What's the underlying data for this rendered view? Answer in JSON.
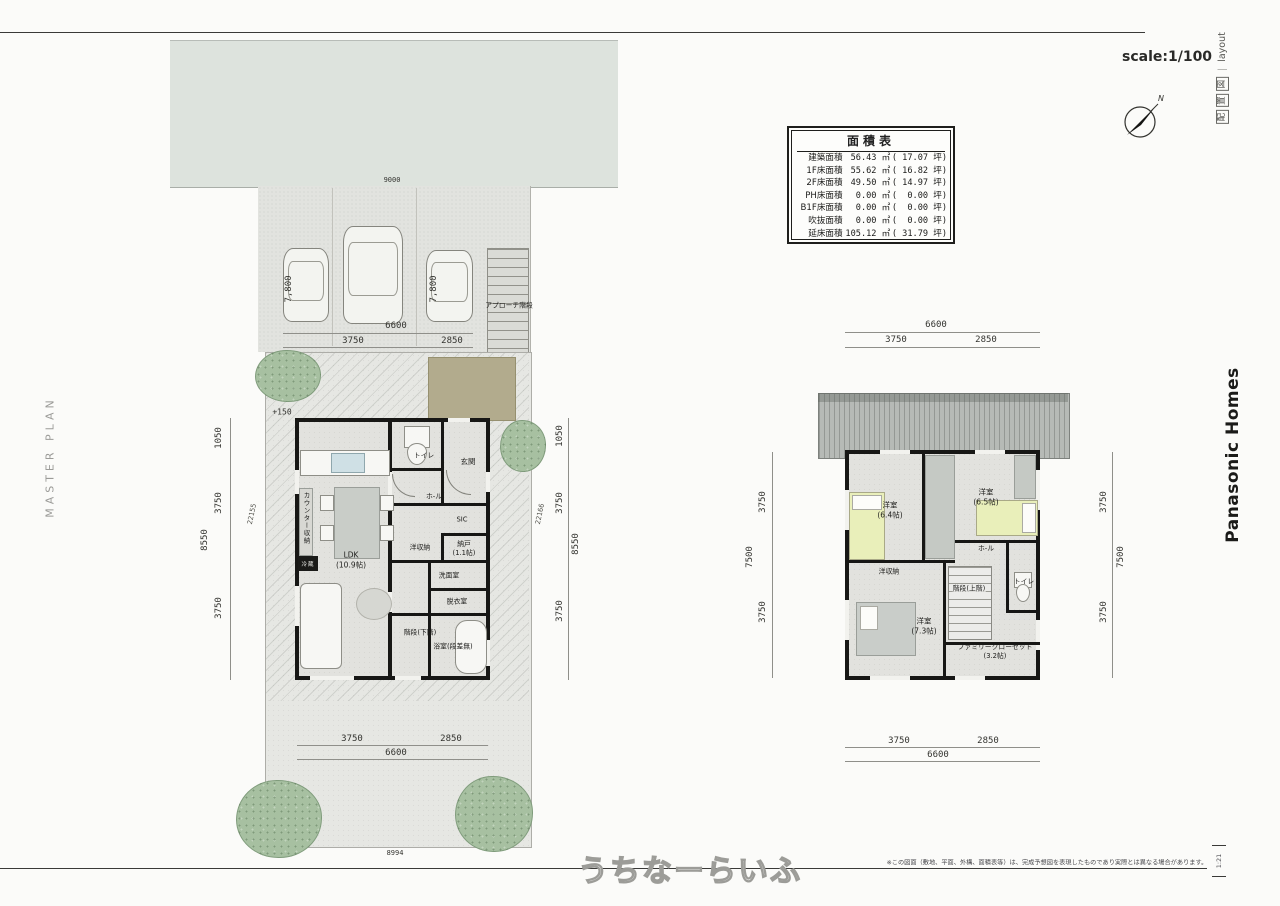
{
  "sheet": {
    "scale_label": "scale:1/100",
    "title_kanji": [
      "配",
      "置",
      "図"
    ],
    "title_sep": "｜",
    "title_en": "layout",
    "compass_n": "N",
    "page_mark": "1:21"
  },
  "branding": {
    "left_vertical": "MASTER PLAN",
    "right_vertical": "Panasonic Homes",
    "watermark": "うちなーらいふ"
  },
  "footer": {
    "disclaimer": "※この図面（敷地、平面、外構、面積表等）は、完成予想図を表現したものであり実際とは異なる場合があります。"
  },
  "area_table": {
    "title": "面積表",
    "rows": [
      {
        "label": "建築面積",
        "value": "56.43 ㎡",
        "tsubo": "( 17.07 坪)"
      },
      {
        "label": "1F床面積",
        "value": "55.62 ㎡",
        "tsubo": "( 16.82 坪)"
      },
      {
        "label": "2F床面積",
        "value": "49.50 ㎡",
        "tsubo": "( 14.97 坪)"
      },
      {
        "label": "PH床面積",
        "value": "0.00 ㎡",
        "tsubo": "(  0.00 坪)"
      },
      {
        "label": "B1F床面積",
        "value": "0.00 ㎡",
        "tsubo": "(  0.00 坪)"
      },
      {
        "label": "吹抜面積",
        "value": "0.00 ㎡",
        "tsubo": "(  0.00 坪)"
      },
      {
        "label": "延床面積",
        "value": "105.12 ㎡",
        "tsubo": "( 31.79 坪)"
      }
    ]
  },
  "site": {
    "road_width": "9000",
    "south_boundary": "8994",
    "level_mark": "+150",
    "approach_label": "アプローチ階段",
    "parking": {
      "stall_depth_left": "7,800",
      "stall_depth_right": "7,800",
      "width_total": "6600",
      "width_left": "3750",
      "width_right": "2850"
    }
  },
  "f1": {
    "rooms": {
      "toilet": "トイレ",
      "genkan": "玄関",
      "hall": "ホ-ル",
      "sic": "SIC",
      "closet": "洋収納",
      "nando": "納戸\n(1.1帖)",
      "senmen": "洗面室",
      "datsui": "脱衣室",
      "stairs": "階段(下階)",
      "bath": "浴室(段差無)",
      "ldk": "LDK\n(10.9帖)",
      "counter": "カウンター収納",
      "fridge": "冷蔵"
    },
    "dims": {
      "left": [
        "1050",
        "3750",
        "3750"
      ],
      "left_total": "8550",
      "left_diag": "22155",
      "right": [
        "1050",
        "3750",
        "3750"
      ],
      "right_total": "8550",
      "right_diag": "22166",
      "bottom": [
        "3750",
        "2850"
      ],
      "bottom_total": "6600"
    }
  },
  "f2": {
    "rooms": {
      "bed1": "洋室\n(6.4帖)",
      "bed2": "洋室\n(6.5帖)",
      "bed3": "洋室\n(7.3帖)",
      "hall": "ホ-ル",
      "closet": "洋収納",
      "toilet": "トイレ",
      "stairs": "階段(上階)",
      "family_closet": "ファミリークローゼット\n(3.2帖)"
    },
    "dims": {
      "top_total": "6600",
      "top": [
        "3750",
        "2850"
      ],
      "bottom": [
        "3750",
        "2850"
      ],
      "bottom_total": "6600",
      "left": [
        "3750",
        "3750"
      ],
      "left_total": "7500",
      "right": [
        "3750",
        "3750"
      ],
      "right_total": "7500"
    }
  }
}
